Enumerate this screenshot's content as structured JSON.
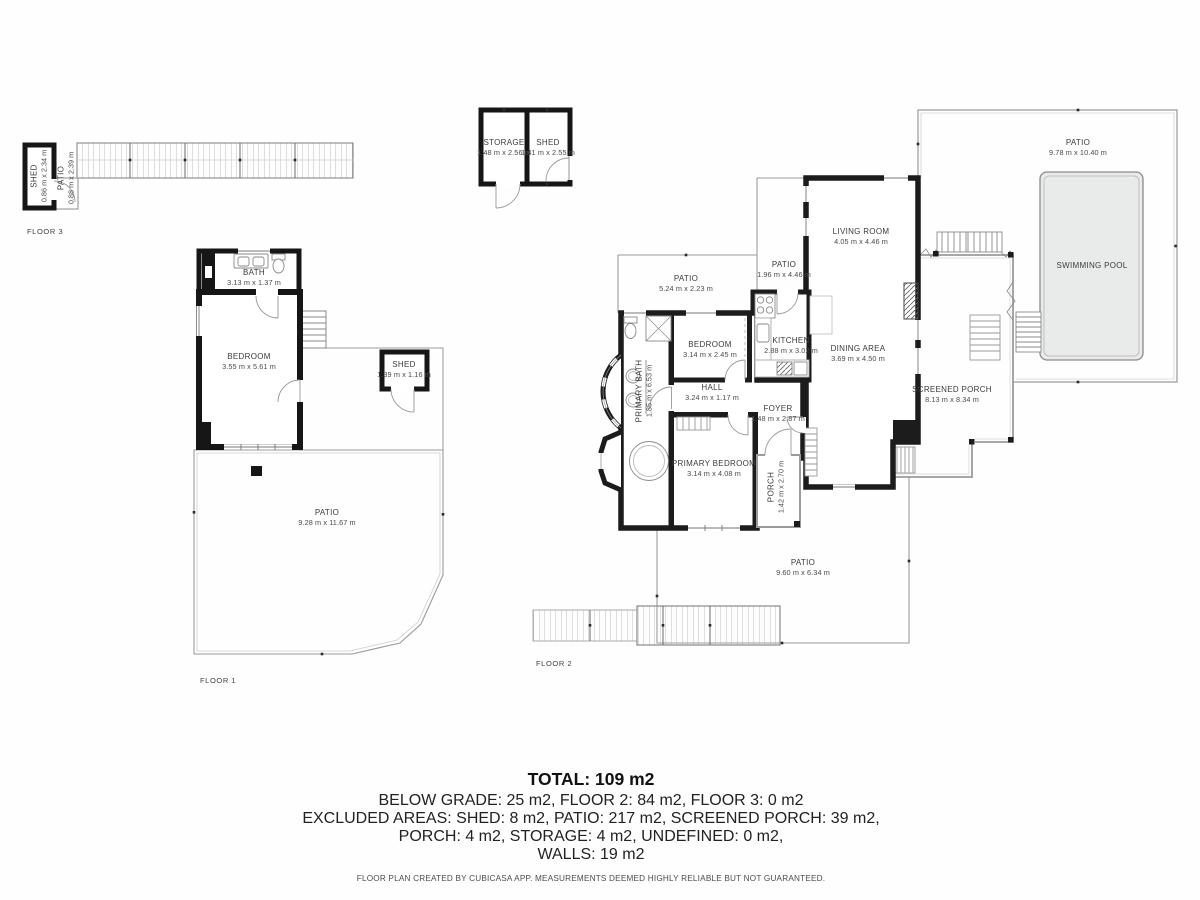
{
  "colors": {
    "wall": "#1c1c1c",
    "thin_line": "#9b9b9b",
    "fixture_line": "#8a8a8a",
    "pool_fill": "#e9ebeb",
    "label_text": "#3b3b3b"
  },
  "floors": {
    "floor1_label": "FLOOR 1",
    "floor2_label": "FLOOR 2",
    "floor3_label": "FLOOR 3"
  },
  "rooms": {
    "f3_shed": {
      "name": "SHED",
      "dims": "0.86 m x 2.34 m"
    },
    "f3_patio": {
      "name": "PATIO",
      "dims": "0.88 m x 2.39 m"
    },
    "ob_storage": {
      "name": "STORAGE",
      "dims": "1.48 m x 2.56 m"
    },
    "ob_shed": {
      "name": "SHED",
      "dims": "1.41 m x 2.55 m"
    },
    "f1_bath": {
      "name": "BATH",
      "dims": "3.13 m x 1.37 m"
    },
    "f1_bedroom": {
      "name": "BEDROOM",
      "dims": "3.55 m x 5.61 m"
    },
    "f1_shed": {
      "name": "SHED",
      "dims": "1.39 m x 1.16 m"
    },
    "f1_patio": {
      "name": "PATIO",
      "dims": "9.28 m x 11.67 m"
    },
    "f2_patio_top": {
      "name": "PATIO",
      "dims": "5.24 m x 2.23 m"
    },
    "f2_patio_side": {
      "name": "PATIO",
      "dims": "1.96 m x 4.46 m"
    },
    "f2_living": {
      "name": "LIVING ROOM",
      "dims": "4.05 m x 4.46 m"
    },
    "f2_kitchen": {
      "name": "KITCHEN",
      "dims": "2.88 m x 3.02 m"
    },
    "f2_dining": {
      "name": "DINING AREA",
      "dims": "3.69 m x 4.50 m"
    },
    "f2_bedroom": {
      "name": "BEDROOM",
      "dims": "3.14 m x 2.45 m"
    },
    "f2_primary_bath": {
      "name": "PRIMARY BATH",
      "dims": "1.85 m x 6.53 m"
    },
    "f2_hall": {
      "name": "HALL",
      "dims": "3.24 m x 1.17 m"
    },
    "f2_foyer": {
      "name": "FOYER",
      "dims": "1.48 m x 2.87 m"
    },
    "f2_primary_bedroom": {
      "name": "PRIMARY BEDROOM",
      "dims": "3.14 m x 4.08 m"
    },
    "f2_porch": {
      "name": "PORCH",
      "dims": "1.42 m x 2.70 m"
    },
    "f2_screened_porch": {
      "name": "SCREENED PORCH",
      "dims": "8.13 m x 8.34 m"
    },
    "f2_pool_patio": {
      "name": "PATIO",
      "dims": "9.78 m x 10.40 m"
    },
    "f2_pool": {
      "name": "SWIMMING POOL"
    },
    "f2_patio_bottom": {
      "name": "PATIO",
      "dims": "9.60 m x 6.34 m"
    }
  },
  "summary": {
    "total": "TOTAL: 109 m2",
    "lines": [
      "BELOW GRADE: 25 m2, FLOOR 2: 84 m2, FLOOR 3: 0 m2",
      "EXCLUDED AREAS: SHED: 8 m2, PATIO: 217 m2, SCREENED PORCH: 39 m2,",
      "PORCH: 4 m2, STORAGE: 4 m2, UNDEFINED: 0 m2,",
      "WALLS: 19 m2"
    ],
    "footer": "FLOOR PLAN CREATED BY CUBICASA APP. MEASUREMENTS DEEMED HIGHLY RELIABLE BUT NOT GUARANTEED."
  }
}
